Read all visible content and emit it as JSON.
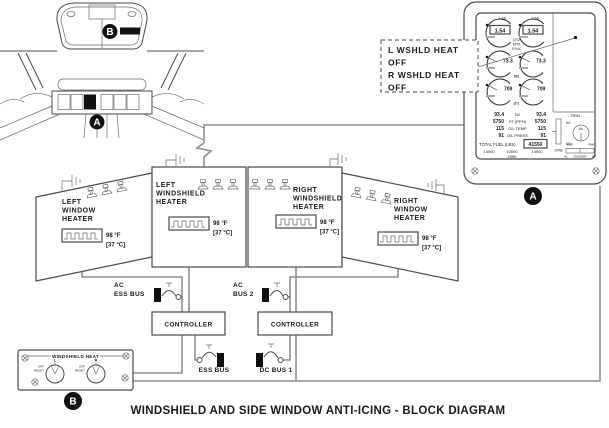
{
  "title": "WINDSHIELD AND SIDE WINDOW ANTI-ICING - BLOCK DIAGRAM",
  "callout_a": "A",
  "callout_b": "B",
  "annunciator": {
    "line1": "L WSHLD HEAT",
    "line2": "OFF",
    "line3": "R WSHLD HEAT",
    "line4": "OFF"
  },
  "heaters": {
    "left_window": {
      "l1": "LEFT",
      "l2": "WINDOW",
      "l3": "HEATER",
      "temp_f": "98 °F",
      "temp_c": "[37 °C]"
    },
    "left_windshield": {
      "l1": "LEFT",
      "l2": "WINDSHIELD",
      "l3": "HEATER",
      "temp_f": "98 °F",
      "temp_c": "[37 °C]"
    },
    "right_windshield": {
      "l1": "RIGHT",
      "l2": "WINDSHIELD",
      "l3": "HEATER",
      "temp_f": "98 °F",
      "temp_c": "[37 °C]"
    },
    "right_window": {
      "l1": "RIGHT",
      "l2": "WINDOW",
      "l3": "HEATER",
      "temp_f": "98 °F",
      "temp_c": "[37 °C]"
    }
  },
  "power": {
    "ac_ess_l1": "AC",
    "ac_ess_l2": "ESS BUS",
    "ac2_l1": "AC",
    "ac2_l2": "BUS 2",
    "ess_bus": "ESS BUS",
    "dc_bus1": "DC BUS 1",
    "controller_left": "CONTROLLER",
    "controller_right": "CONTROLLER"
  },
  "control_panel": {
    "title": "WINDSHIELD HEAT",
    "l_knob": "L",
    "r_knob": "R",
    "off": "OFF",
    "reset": "RESET"
  },
  "eicas": {
    "epr": {
      "left_target": "1.68",
      "left_value": "1.54",
      "right_target": "1.68",
      "right_value": "1.54",
      "mode1": "CRZ",
      "mode2": "EPR",
      "mode3": "SYNC"
    },
    "n1": {
      "left": "73.3",
      "right": "73.3",
      "label": "N1"
    },
    "itt": {
      "left": "709",
      "right": "709",
      "label": "ITT"
    },
    "rows": [
      {
        "left": "93.4",
        "label": "N2",
        "right": "93.4"
      },
      {
        "left": "5750",
        "label": "FF (PPH)",
        "right": "5750"
      },
      {
        "left": "115",
        "label": "OIL TEMP",
        "right": "115"
      },
      {
        "left": "91",
        "label": "OIL PRESS",
        "right": "91"
      }
    ],
    "fuel": {
      "label": "TOTAL FUEL (LBS)",
      "total": "41550",
      "tank_l": "14000",
      "tank_c": "10000",
      "tank_r": "14000",
      "aux": "2550"
    },
    "trim": {
      "title": "- TRIM -",
      "nu": "NU",
      "nd": "ND",
      "stab": "STAB",
      "ail": "AIL",
      "lwd": "LWD",
      "rwd": "RWD",
      "nl": "NL",
      "rudder": "RUDDER",
      "nr": "NR"
    }
  }
}
